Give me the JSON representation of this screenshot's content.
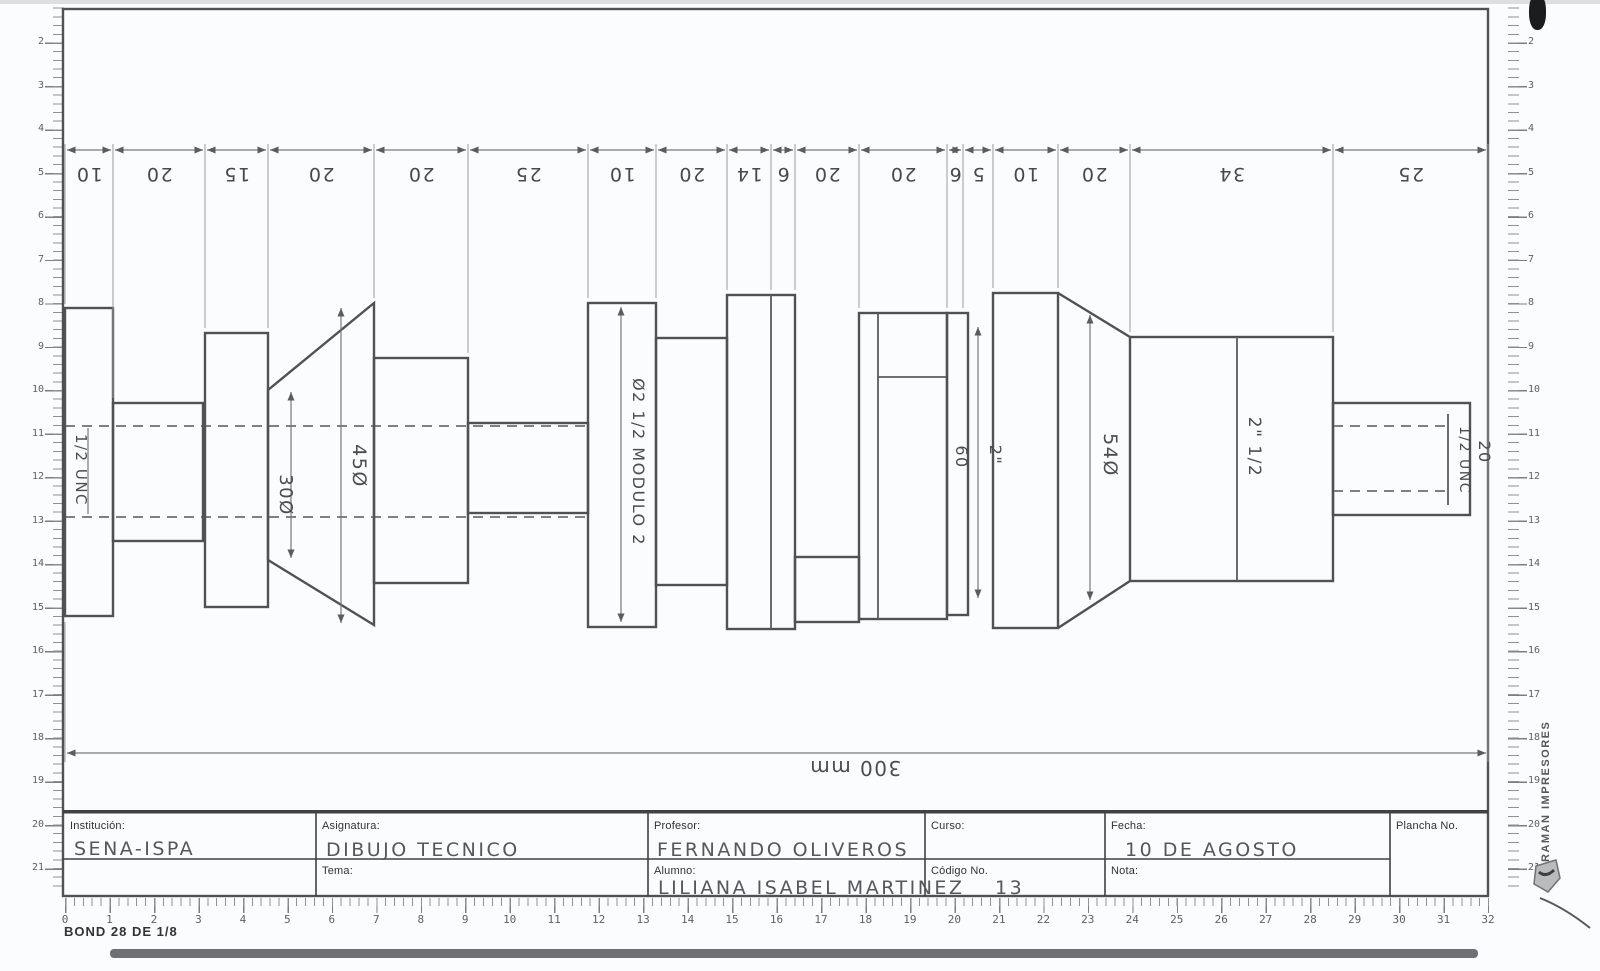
{
  "sheet": {
    "paper_type": "BOND 28 DE 1/8",
    "printer_mark": "RAMAN IMPRESORES"
  },
  "title_block": {
    "institucion_label": "Institución:",
    "institucion_value": "SENA-ISPA",
    "asignatura_label": "Asignatura:",
    "asignatura_value": "DIBUJO TECNICO",
    "tema_label": "Tema:",
    "tema_value": "",
    "profesor_label": "Profesor:",
    "profesor_value": "FERNANDO OLIVEROS",
    "alumno_label": "Alumno:",
    "alumno_value": "LILIANA ISABEL MARTINEZ",
    "curso_label": "Curso:",
    "curso_value": "",
    "codigo_label": "Código No.",
    "codigo_value": "13",
    "fecha_label": "Fecha:",
    "fecha_value": "10 DE AGOSTO",
    "nota_label": "Nota:",
    "nota_value": "",
    "plancha_label": "Plancha No.",
    "plancha_value": ""
  },
  "drawing": {
    "overall_dimension": "300 mm",
    "dimension_chain": [
      "10",
      "20",
      "15",
      "20",
      "20",
      "25",
      "10",
      "20",
      "14",
      "6",
      "20",
      "20",
      "6",
      "5",
      "10",
      "20",
      "34",
      "25"
    ],
    "labels": {
      "thread_left": "1/2 UNC",
      "dia30": "30Ø",
      "dia45": "45Ø",
      "gear": "Ø2 1/2 MODULO 2",
      "len60": "60",
      "dia2in": "2\"",
      "dia54": "54Ø",
      "dia2half": "2\" 1/2",
      "thread_right": "1/2 UNC",
      "len20": "20"
    }
  },
  "rulers": {
    "left_numbers": [
      "1",
      "2",
      "3",
      "4",
      "5",
      "6",
      "7",
      "8",
      "9",
      "10",
      "11",
      "12",
      "13",
      "14",
      "15",
      "16",
      "17",
      "18",
      "19",
      "20",
      "21"
    ],
    "right_numbers": [
      "1",
      "2",
      "3",
      "4",
      "5",
      "6",
      "7",
      "8",
      "9",
      "10",
      "11",
      "12",
      "13",
      "14",
      "15",
      "16",
      "17",
      "18",
      "19",
      "20",
      "21"
    ],
    "bottom_numbers": [
      "0",
      "1",
      "2",
      "3",
      "4",
      "5",
      "6",
      "7",
      "8",
      "9",
      "10",
      "11",
      "12",
      "13",
      "14",
      "15",
      "16",
      "17",
      "18",
      "19",
      "20",
      "21",
      "22",
      "23",
      "24",
      "25",
      "26",
      "27",
      "28",
      "29",
      "30",
      "31",
      "32"
    ]
  }
}
